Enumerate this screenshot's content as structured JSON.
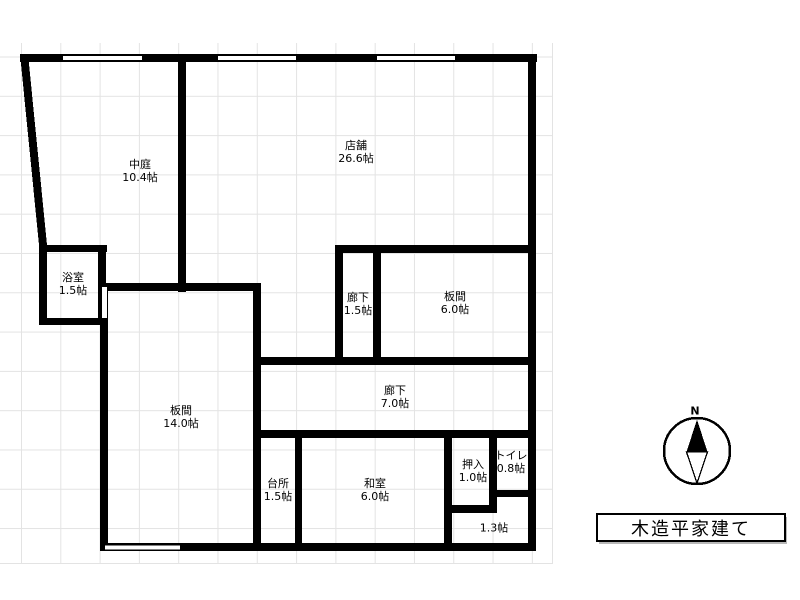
{
  "floor_plan": {
    "rooms": [
      {
        "name": "中庭",
        "size": "10.4帖"
      },
      {
        "name": "店舗",
        "size": "26.6帖"
      },
      {
        "name": "浴室",
        "size": "1.5帖"
      },
      {
        "name": "廊下",
        "size": "1.5帖"
      },
      {
        "name": "板間",
        "size": "6.0帖"
      },
      {
        "name": "廊下",
        "size": "7.0帖"
      },
      {
        "name": "板間",
        "size": "14.0帖"
      },
      {
        "name": "台所",
        "size": "1.5帖"
      },
      {
        "name": "和室",
        "size": "6.0帖"
      },
      {
        "name": "押入",
        "size": "1.0帖"
      },
      {
        "name": "トイレ",
        "size": "0.8帖"
      },
      {
        "name": "",
        "size": "1.3帖"
      }
    ],
    "compass": {
      "north_label": "N"
    },
    "caption": {
      "building_type": "木造平家建て"
    }
  },
  "colors": {
    "wall": "#000000",
    "grid_line": "#e3e3e3",
    "background": "#ffffff",
    "text": "#000000"
  }
}
